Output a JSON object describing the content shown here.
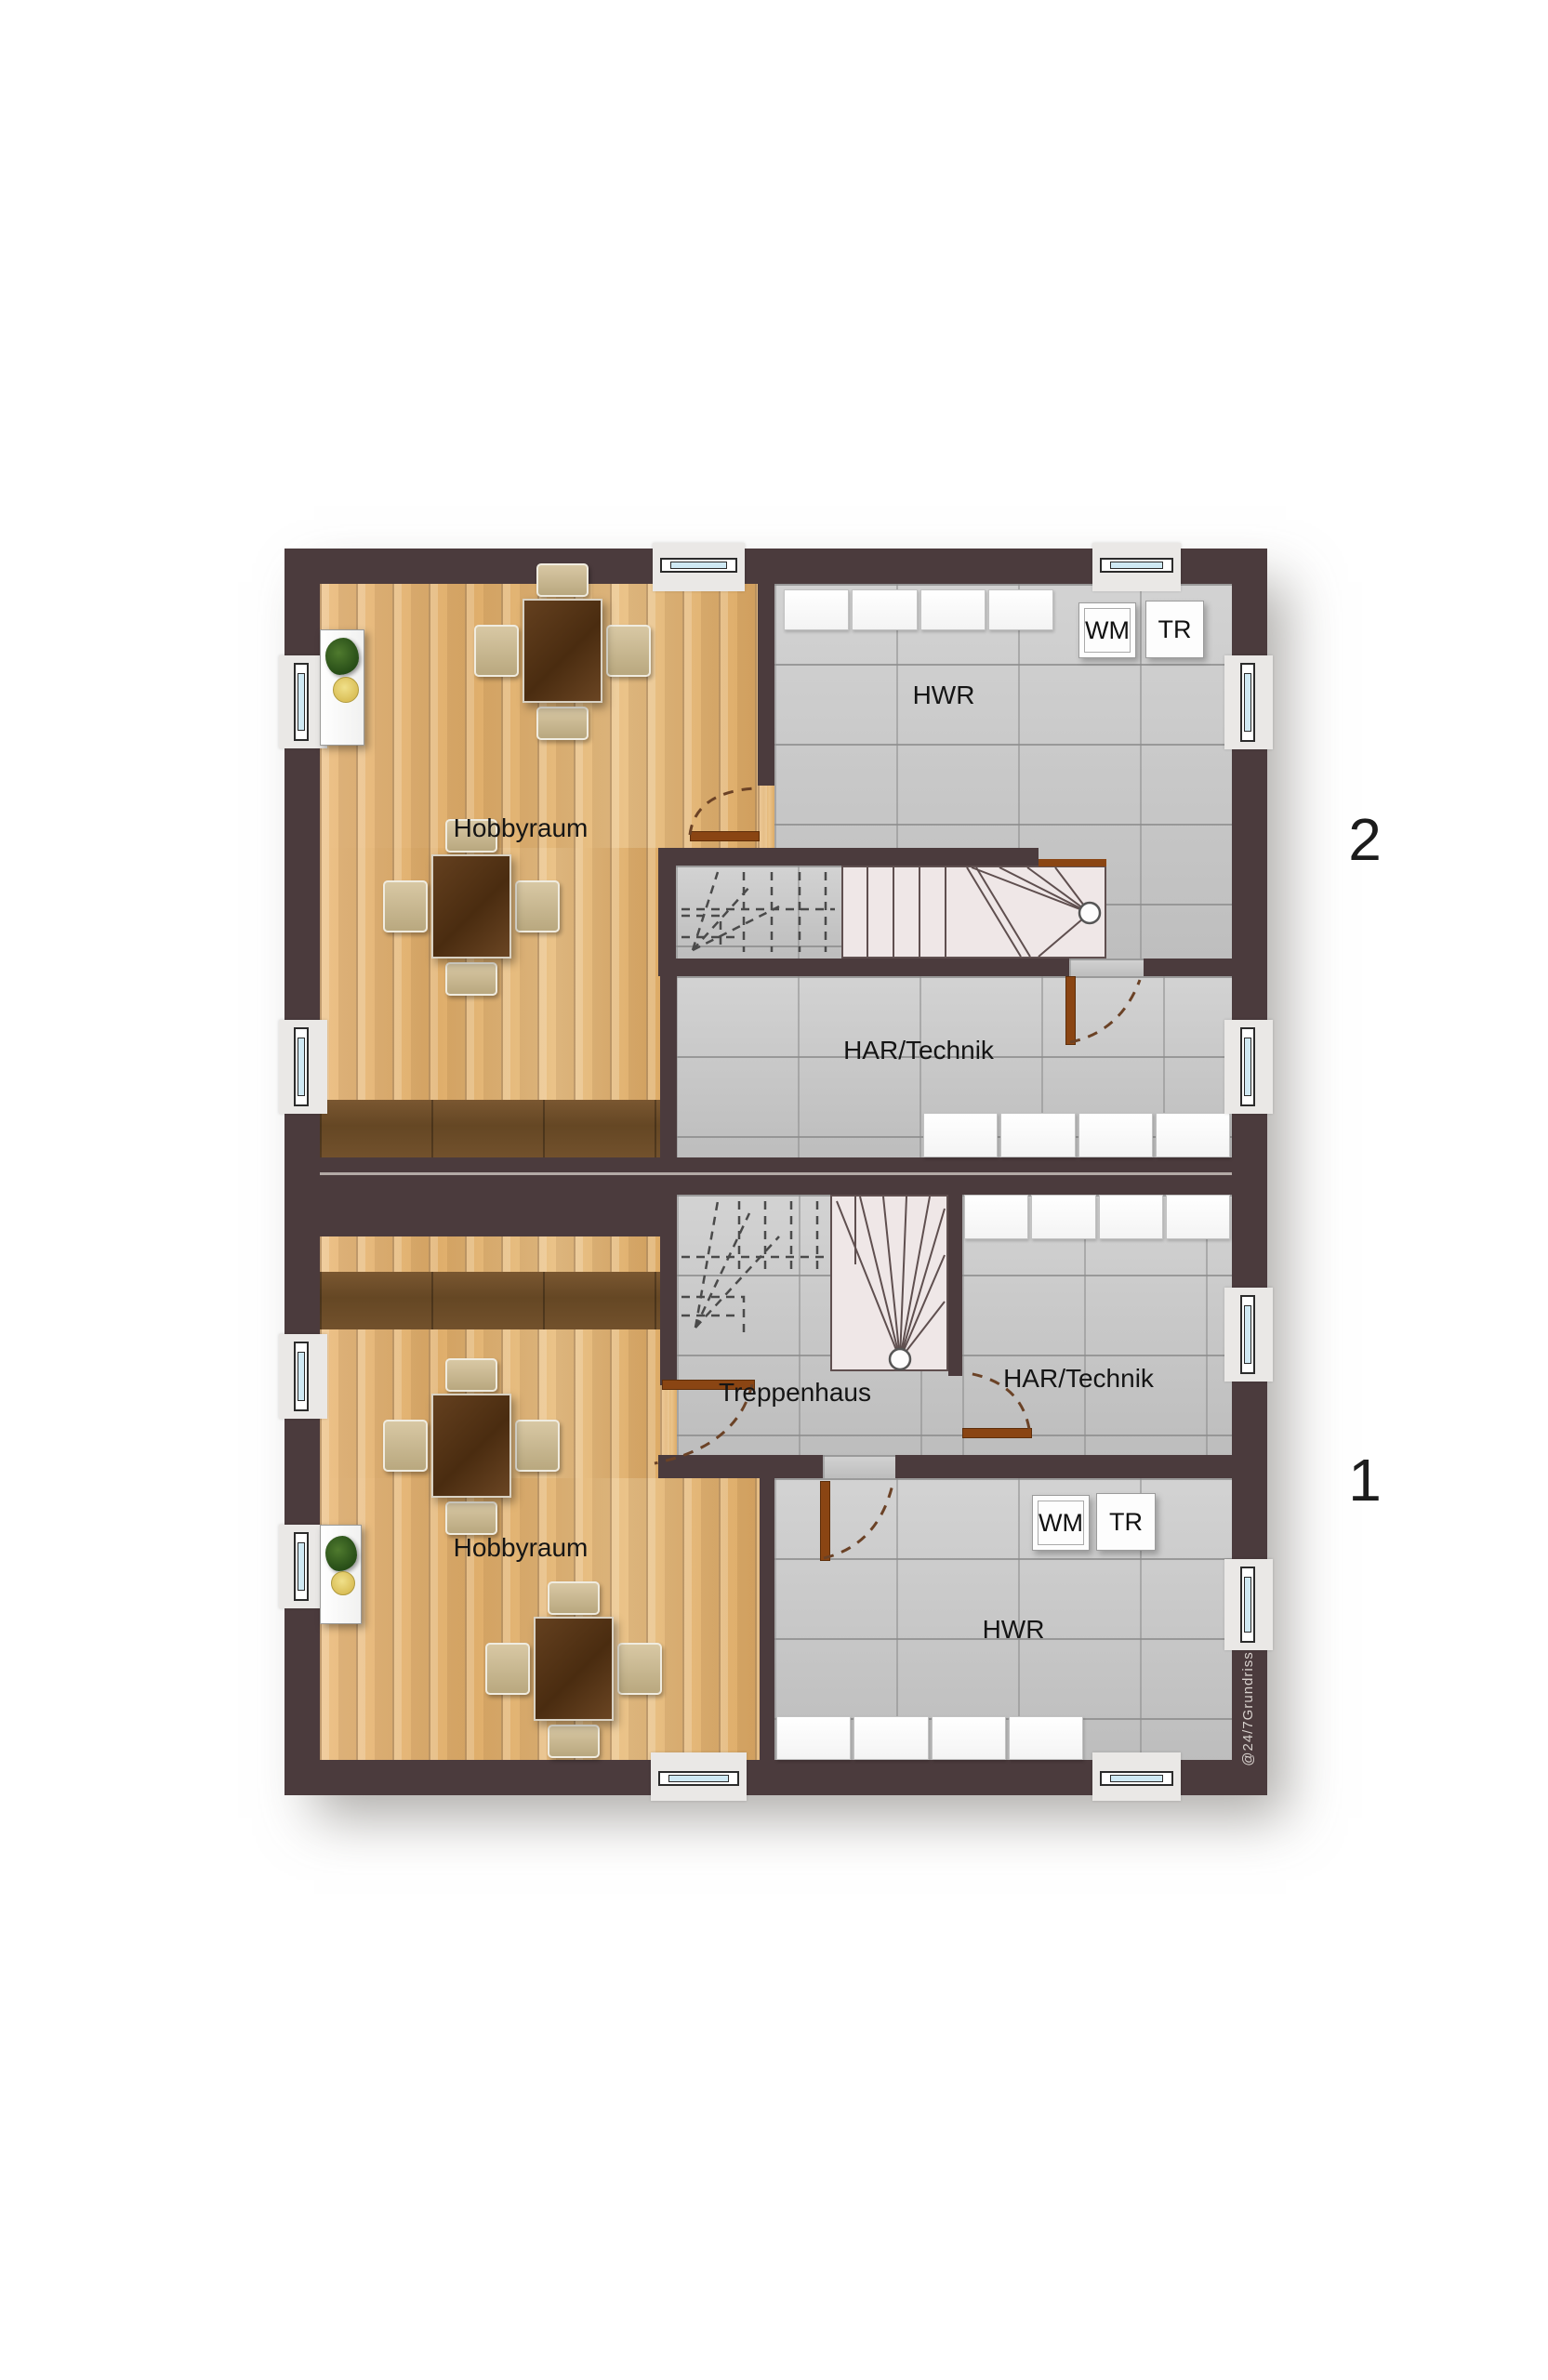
{
  "units": {
    "upper": {
      "marker": "2",
      "rooms": {
        "hobbyraum": "Hobbyraum",
        "hwr": "HWR",
        "har": "HAR/Technik"
      },
      "appliances": {
        "wm": "WM",
        "tr": "TR"
      }
    },
    "lower": {
      "marker": "1",
      "rooms": {
        "hobbyraum": "Hobbyraum",
        "hwr": "HWR",
        "har": "HAR/Technik",
        "treppenhaus": "Treppenhaus"
      },
      "appliances": {
        "wm": "WM",
        "tr": "TR"
      }
    }
  },
  "watermark": "@24/7Grundriss",
  "colors": {
    "wall": "#4b3b3d",
    "wood_light": "#e9c084",
    "wood_dark": "#6d4c2a",
    "tile": "#c9c9c9",
    "stair": "#efe7e7",
    "door": "#8a4513",
    "window_glass": "#cfe9f4"
  }
}
